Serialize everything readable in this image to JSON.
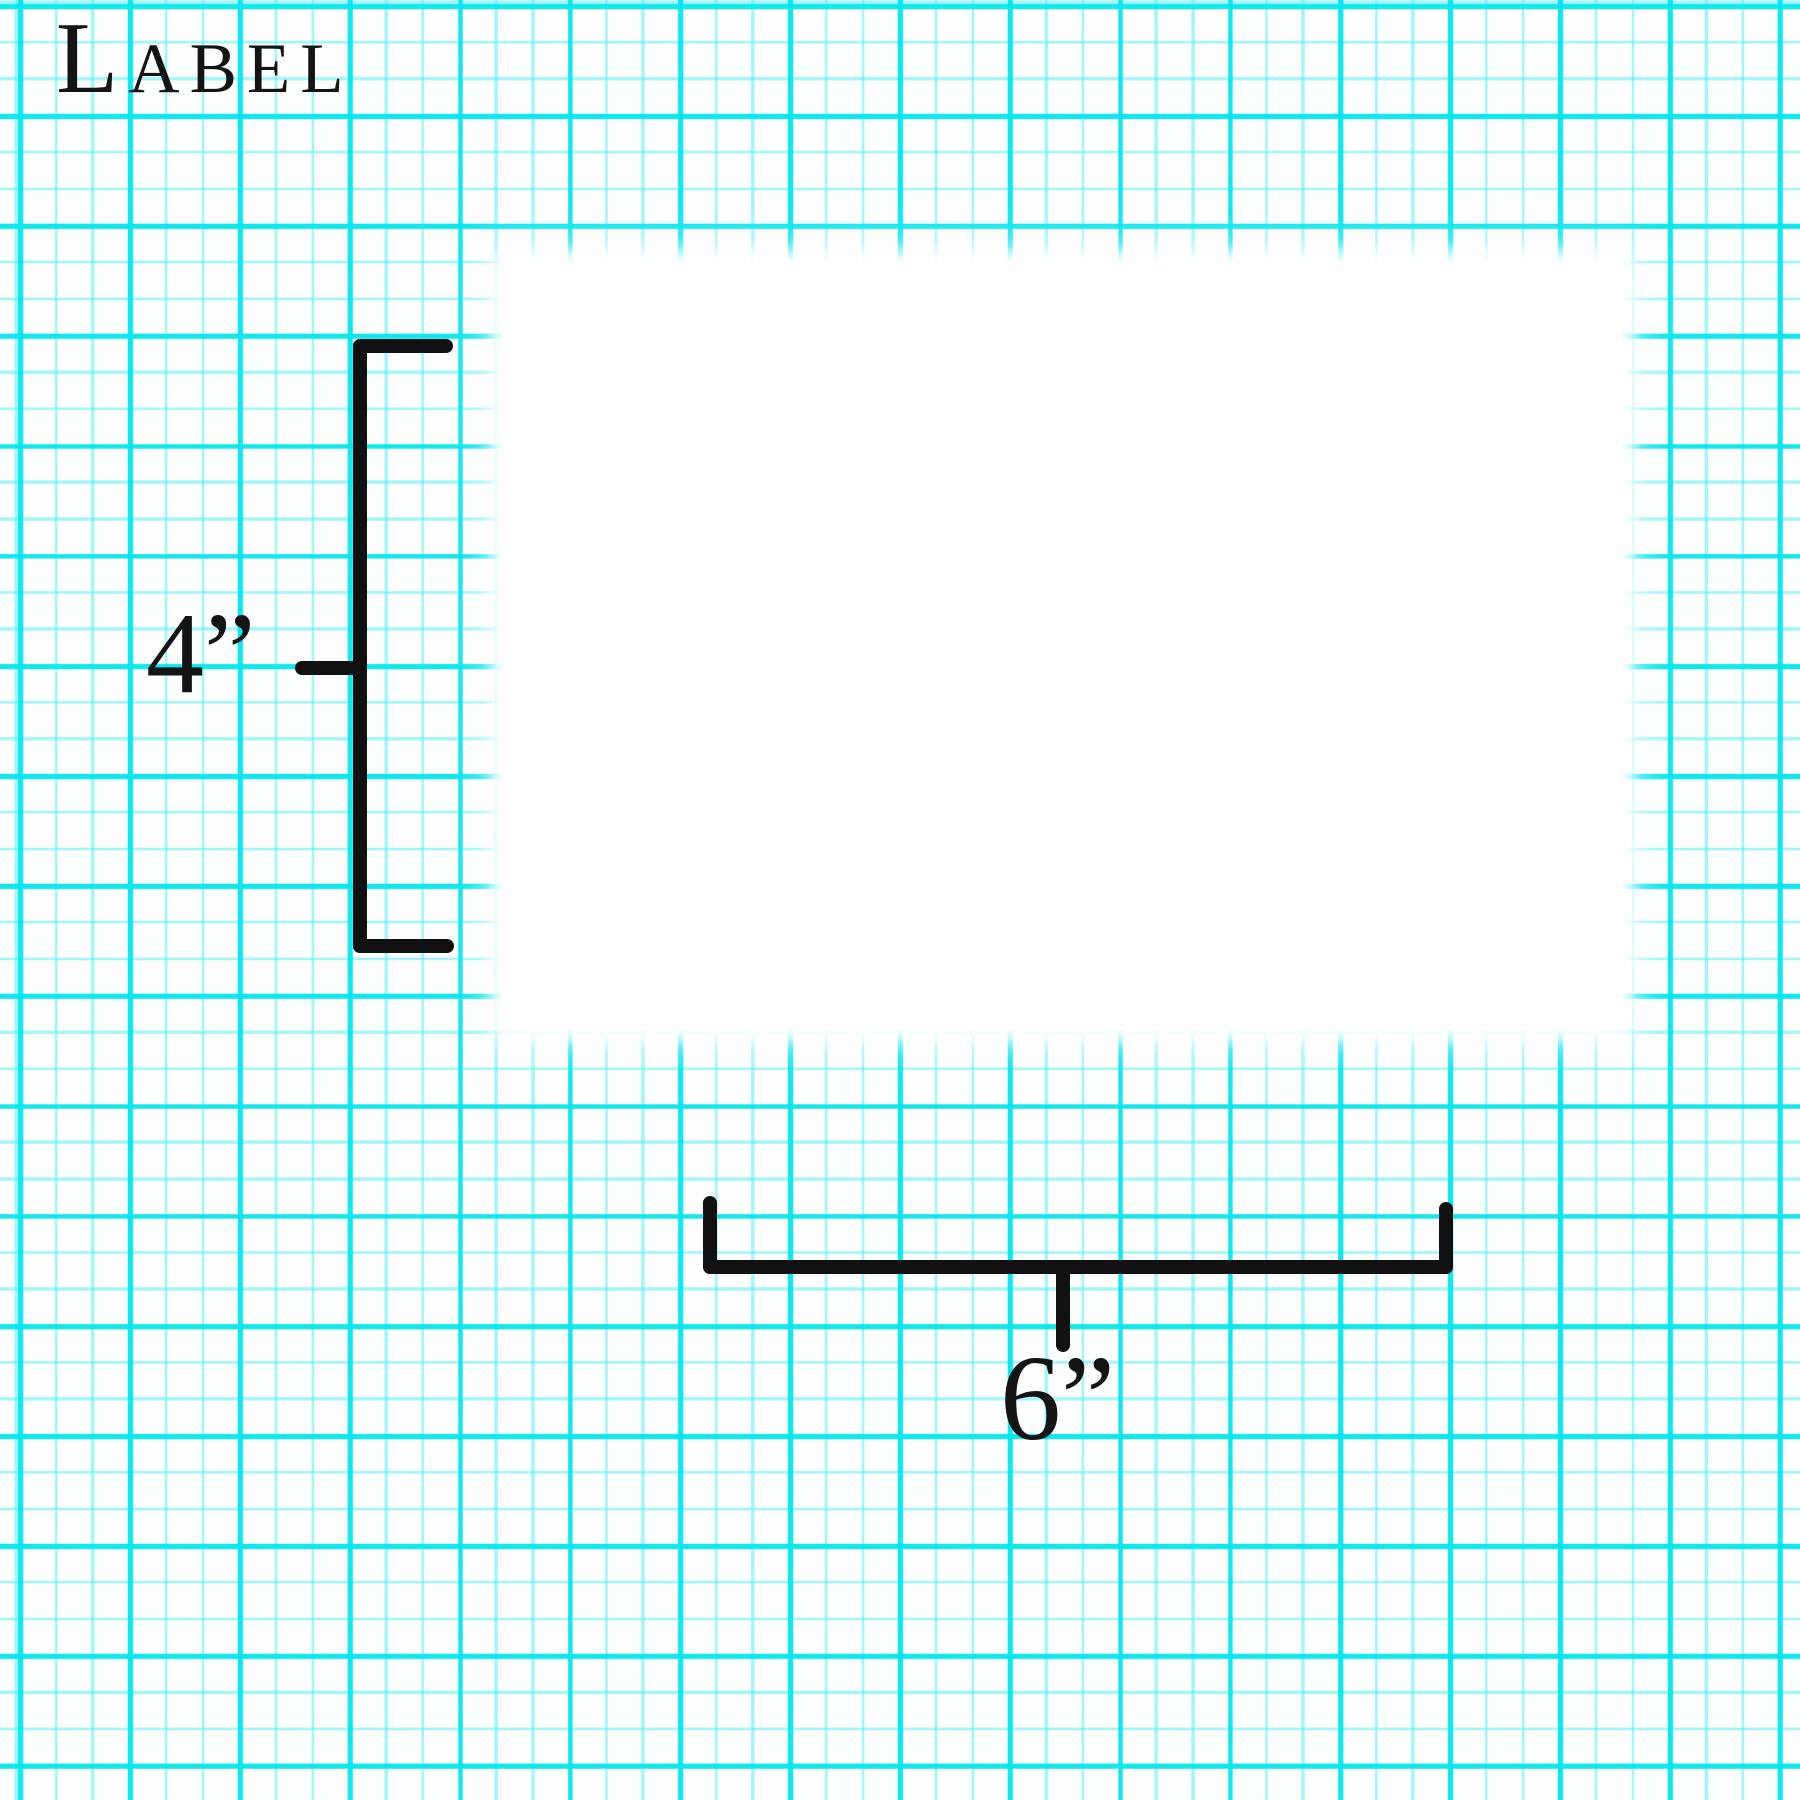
{
  "page": {
    "title": "Label"
  },
  "label_preview": {
    "description": "blank white label"
  },
  "dimensions": {
    "height": {
      "value": "4”",
      "inches": 4
    },
    "width": {
      "value": "6”",
      "inches": 6
    }
  },
  "colors": {
    "grid_major": "#02e6ee",
    "grid_minor": "#5aeef4",
    "paper": "#fdfefe",
    "ink": "#111111",
    "label": "#ffffff"
  }
}
